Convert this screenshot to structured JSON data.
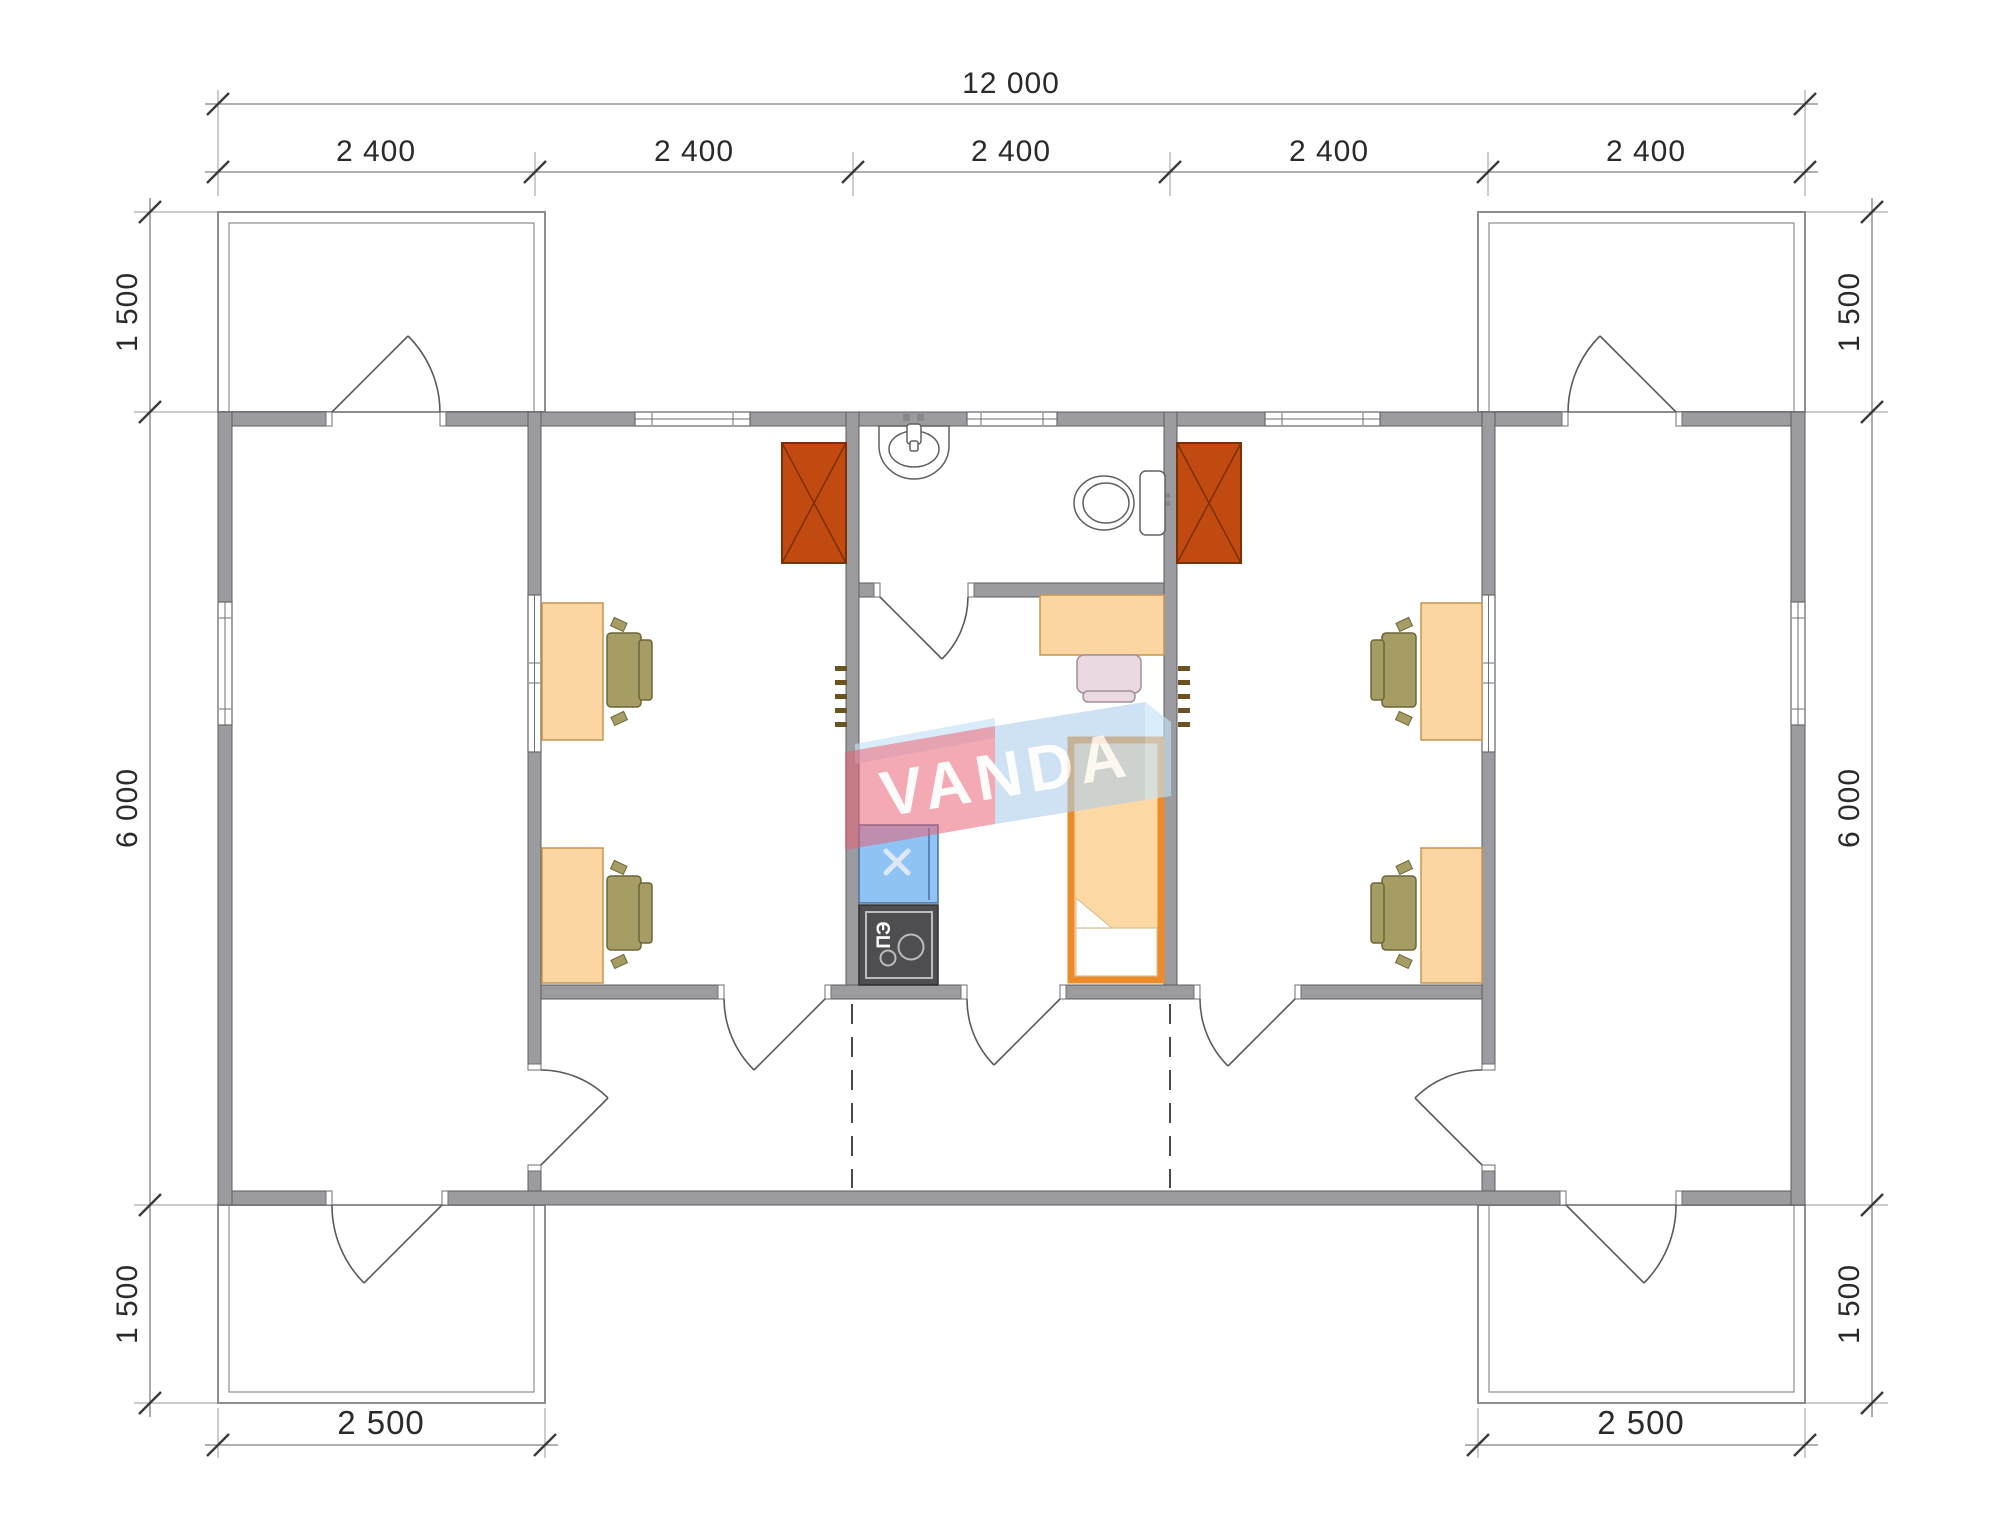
{
  "watermark": {
    "text": "VANDA",
    "red": "#ea5f72",
    "blue": "#a9cdec",
    "flap": "#c4e1f6"
  },
  "dimensions": {
    "overall_width": "12 000",
    "bays": [
      "2 400",
      "2 400",
      "2 400",
      "2 400",
      "2 400"
    ],
    "left_side": {
      "top": "1 500",
      "middle": "6 000",
      "bottom": "1 500"
    },
    "right_side": {
      "top": "1 500",
      "middle": "6 000",
      "bottom": "1 500"
    },
    "porch_bottom_left": "2 500",
    "porch_bottom_right": "2 500"
  },
  "appliances": {
    "electric_stove_label": "ПЭ"
  },
  "furniture_icons": [
    "desk",
    "office-chair",
    "storage-unit-crossed",
    "radiator",
    "washbasin",
    "toilet",
    "kitchen-sink-unit",
    "electric-stove",
    "bed",
    "bedroom-chair",
    "door-swing",
    "window"
  ],
  "colors": {
    "wall": "#9c9ca0",
    "desk": "#fcd6a2",
    "office_chair": "#a59d63",
    "storage_unit": "#c14a10",
    "kitchen_sink": "#8fc3f3",
    "stove": "#4e4e50",
    "bed_frame": "#ec8b28",
    "bed_mattress": "#fcd8a4",
    "bedroom_chair": "#ead9e2",
    "watermark_red": "#ea5f72",
    "watermark_blue": "#a9cdec"
  }
}
